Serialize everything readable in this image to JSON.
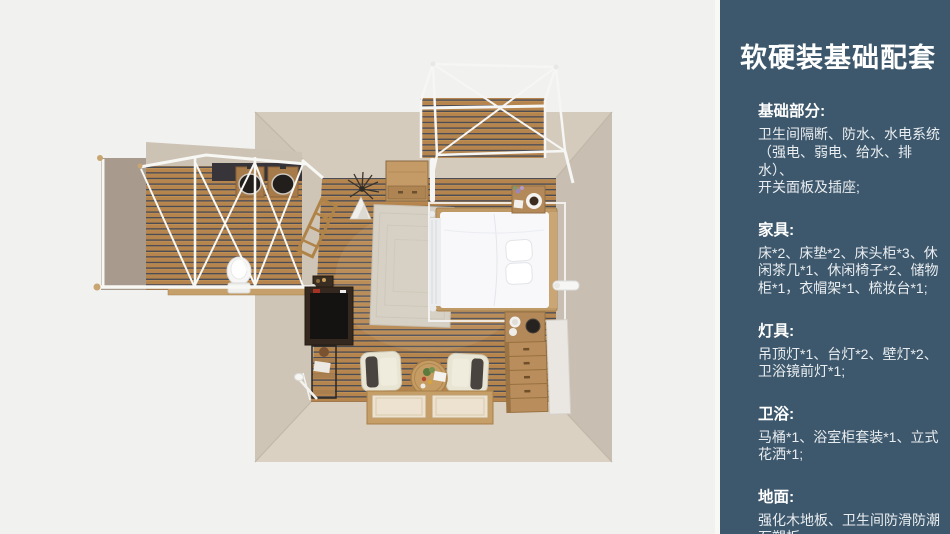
{
  "page": {
    "background_color": "#f1f1ef"
  },
  "panel": {
    "background_color": "#3d586c",
    "divider_color": "#f8f8f5",
    "title": "软硬装基础配套",
    "sections": [
      {
        "heading": "基础部分:",
        "lines": [
          "卫生间隔断、防水、水电系统",
          "（强电、弱电、给水、排水）、",
          "开关面板及插座;"
        ]
      },
      {
        "heading": "家具:",
        "lines": [
          "床*2、床垫*2、床头柜*3、休",
          "闲茶几*1、休闲椅子*2、储物",
          "柜*1，衣帽架*1、梳妆台*1;"
        ]
      },
      {
        "heading": "灯具:",
        "lines": [
          "吊顶灯*1、台灯*2、壁灯*2、",
          "卫浴镜前灯*1;"
        ]
      },
      {
        "heading": "卫浴:",
        "lines": [
          "马桶*1、浴室柜套装*1、立式",
          "花洒*1;"
        ]
      },
      {
        "heading": "地面:",
        "lines": [
          "强化木地板、卫生间防滑防潮",
          "石塑板;"
        ]
      }
    ]
  },
  "floorplan": {
    "colors": {
      "wall": "#d4cbbd",
      "wall_shaded": "#c8beb1",
      "wall_dark": "#a89a8c",
      "wood_plank": "#b5854d",
      "plank_gap": "#4c4c55",
      "frame_white": "#f7f7f4",
      "bed_linen": "#f8f8fa",
      "bed_frame": "#c09a66",
      "rug": "#d7d1c5"
    }
  }
}
